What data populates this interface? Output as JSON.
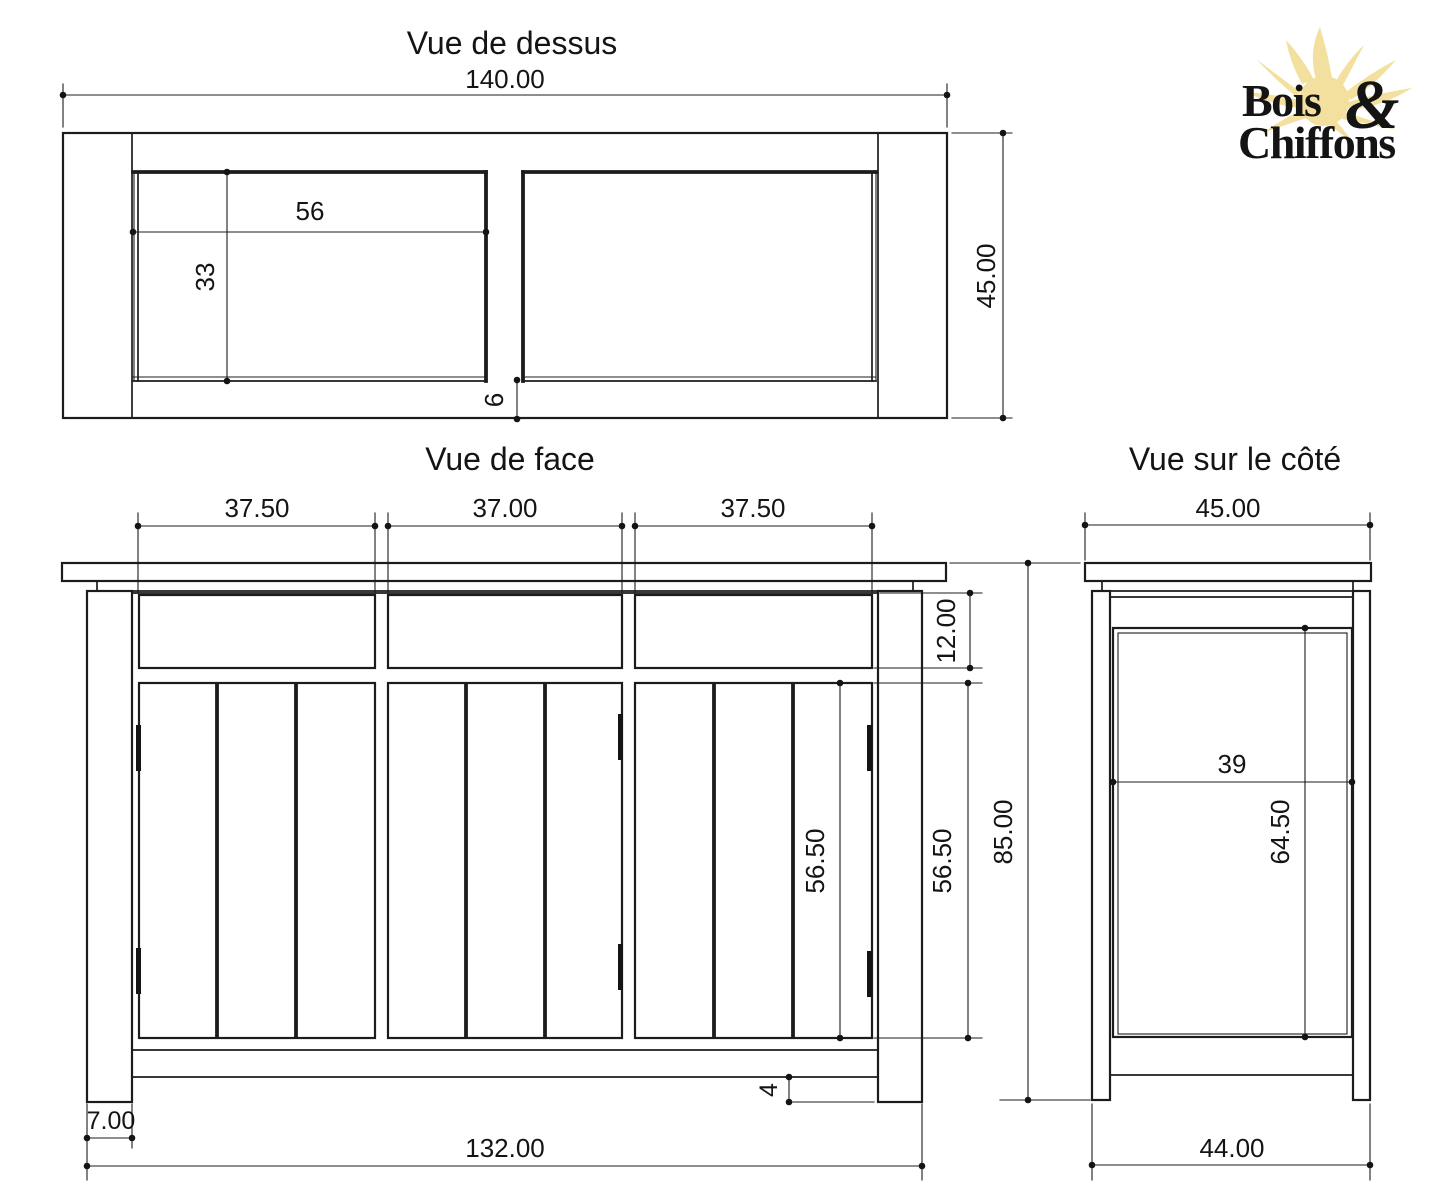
{
  "drawing": {
    "line_color": "#1c1c1c",
    "background": "#ffffff"
  },
  "views": {
    "top": {
      "title": "Vue de dessus",
      "dim_width": "140.00",
      "dim_depth": "45.00",
      "dim_panel_width": "56",
      "dim_panel_depth": "33",
      "dim_divider": "6"
    },
    "front": {
      "title": "Vue de face",
      "dim_door_left": "37.50",
      "dim_door_center": "37.00",
      "dim_door_right": "37.50",
      "dim_drawer_height": "12.00",
      "dim_door_height_inner": "56.50",
      "dim_door_height_outer": "56.50",
      "dim_total_height": "85.00",
      "dim_plinth_gap": "4",
      "dim_leg_width": "7.00",
      "dim_inner_width": "132.00"
    },
    "side": {
      "title": "Vue sur le côté",
      "dim_top_depth": "45.00",
      "dim_panel_width": "39",
      "dim_panel_height": "64.50",
      "dim_base_depth": "44.00"
    }
  },
  "logo": {
    "word_top": "Bois",
    "ampersand": "&",
    "word_bottom": "Chiffons",
    "colors": {
      "brown": "#5a3318",
      "blue": "#2ea3df",
      "sun": "#f3e09e"
    }
  }
}
